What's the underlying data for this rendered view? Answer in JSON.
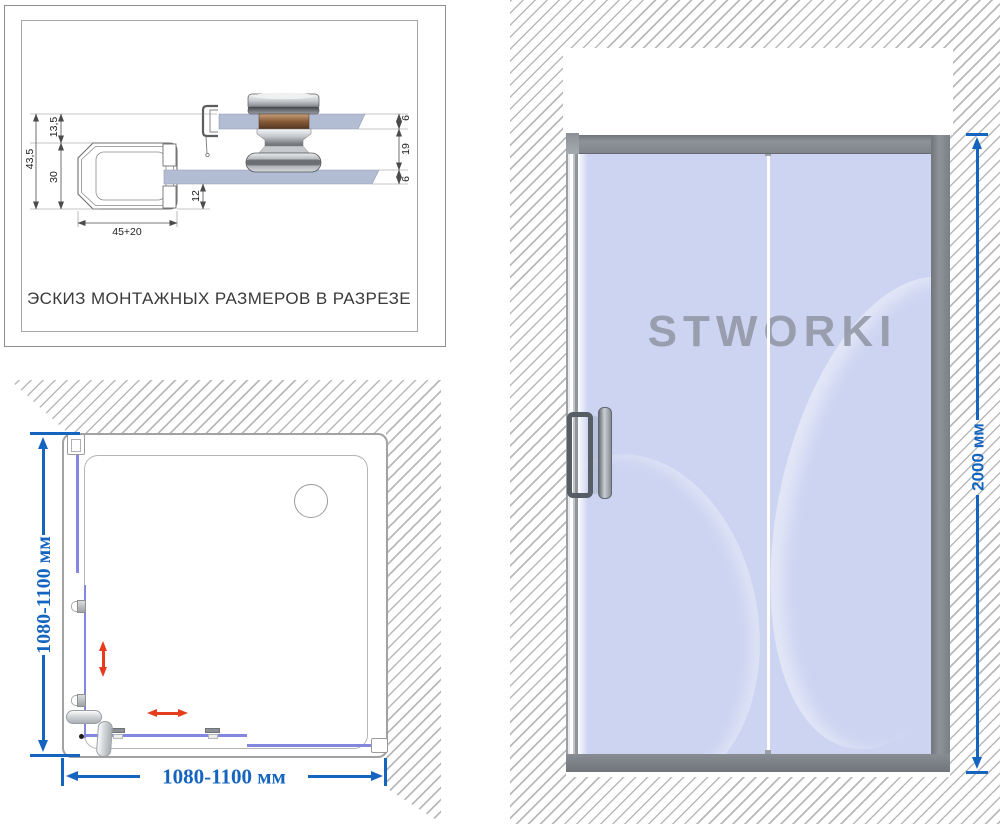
{
  "colors": {
    "accent-blue": "#1565c0",
    "arrow-red": "#e63c1e",
    "glass-blue": "#ccd4f1",
    "frame-gray": "#868c92",
    "hatch-line": "#b9b9b9",
    "glass-line-purple": "#8387dd",
    "dim-line-gray": "#4b4b4b"
  },
  "section_view": {
    "caption": "ЭСКИЗ МОНТАЖНЫХ РАЗМЕРОВ В РАЗРЕЗЕ",
    "dims": {
      "overall_height": "43,5",
      "upper_offset": "13,5",
      "profile_height": "30",
      "profile_width": "45+20",
      "glass_inset": "12",
      "glass_top_thickness": "6",
      "panel_gap": "19",
      "glass_bottom_thickness": "6"
    }
  },
  "plan_view": {
    "watermark": "STWORKI",
    "width_label": "1080-1100 мм",
    "depth_label": "1080-1100 мм"
  },
  "front_view": {
    "watermark": "STWORKI",
    "height_label": "2000 мм"
  }
}
